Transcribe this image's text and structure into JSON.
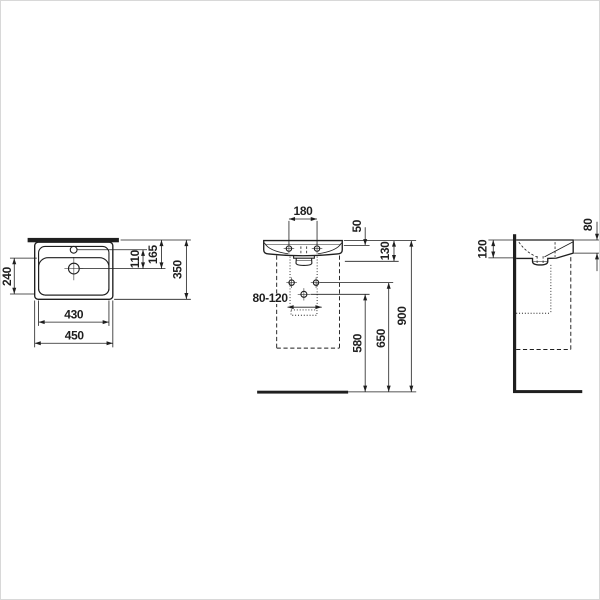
{
  "colors": {
    "line": "#1f1f1f",
    "background": "#ffffff",
    "frame_border": "#d8d8d8"
  },
  "views": {
    "plan": {
      "dims": {
        "bowl_depth": "240",
        "bowl_width": "430",
        "overall_width": "450",
        "tap_to_drain": "110",
        "rear_to_drain": "165",
        "overall_depth": "350"
      }
    },
    "front": {
      "dims": {
        "fixing_hole_spacing": "180",
        "rim_to_fixing_holes": "50",
        "rim_to_outlet_bottom": "130",
        "supply_spacing_range": "80-120",
        "floor_to_waste": "580",
        "floor_to_supply": "650",
        "floor_to_rim": "900"
      }
    },
    "side": {
      "dims": {
        "rear_height": "120",
        "front_edge_height": "80"
      }
    }
  }
}
